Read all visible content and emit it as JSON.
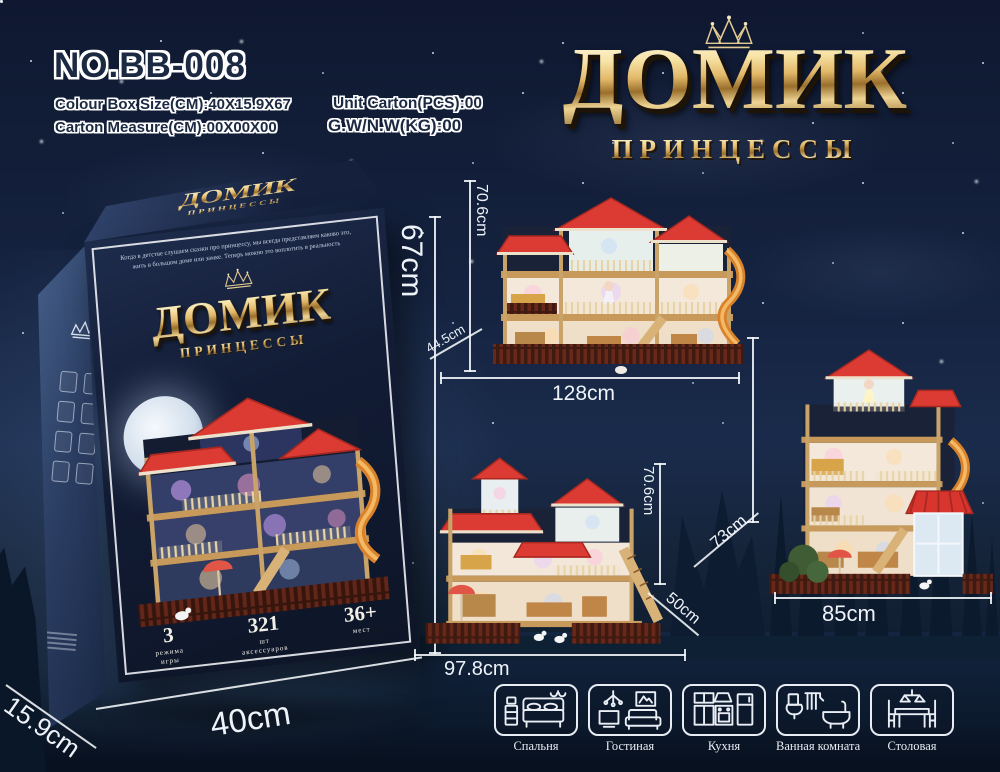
{
  "header": {
    "model_no": "NO.BB-008",
    "spec_box_size": "Colour Box Size(CM):40X15.9X67",
    "spec_unit_carton": "Unit Carton(PCS):00",
    "spec_carton_measure": "Carton Measure(CM):00X00X00",
    "spec_gw_nw": "G.W/N.W(KG):00"
  },
  "title": {
    "main": "ДОМИК",
    "sub": "ПРИНЦЕССЫ",
    "icon": "crown-icon"
  },
  "box": {
    "top_logo_main": "ДОМИК",
    "top_logo_sub": "ПРИНЦЕССЫ",
    "desc1": "Когда в детстве слушаем сказки про принцессу, мы всегда представляем каково это,",
    "desc2": "жить в большом доме или замке. Теперь можно это воплотить в реальность",
    "logo_main": "ДОМИК",
    "logo_sub": "ПРИНЦЕССЫ",
    "features": [
      {
        "value": "3",
        "label": "режима\nигры"
      },
      {
        "value": "321",
        "label": "шт\nаксессуаров"
      },
      {
        "value": "36+",
        "label": "мест"
      }
    ],
    "dims": {
      "height": "67cm",
      "width": "40cm",
      "depth": "15.9cm"
    }
  },
  "houses": {
    "large": {
      "height": "70.6cm",
      "depth": "44.5cm",
      "width": "128cm"
    },
    "medium": {
      "height": "70.6cm",
      "depth": "50cm",
      "width": "97.8cm"
    },
    "tall": {
      "depth": "73cm",
      "width": "85cm"
    }
  },
  "rooms": [
    {
      "label": "Спальня",
      "icon": "bedroom-icon"
    },
    {
      "label": "Гостиная",
      "icon": "living-room-icon"
    },
    {
      "label": "Кухня",
      "icon": "kitchen-icon"
    },
    {
      "label": "Ванная комната",
      "icon": "bathroom-icon"
    },
    {
      "label": "Столовая",
      "icon": "dining-room-icon"
    }
  ],
  "colors": {
    "background_navy": "#152340",
    "gold_accent": "#e7c77e",
    "roof_red": "#dc3b33",
    "slide_orange": "#e0862e",
    "dimension_white": "#eef3fa",
    "fence_brown": "#68281a"
  }
}
